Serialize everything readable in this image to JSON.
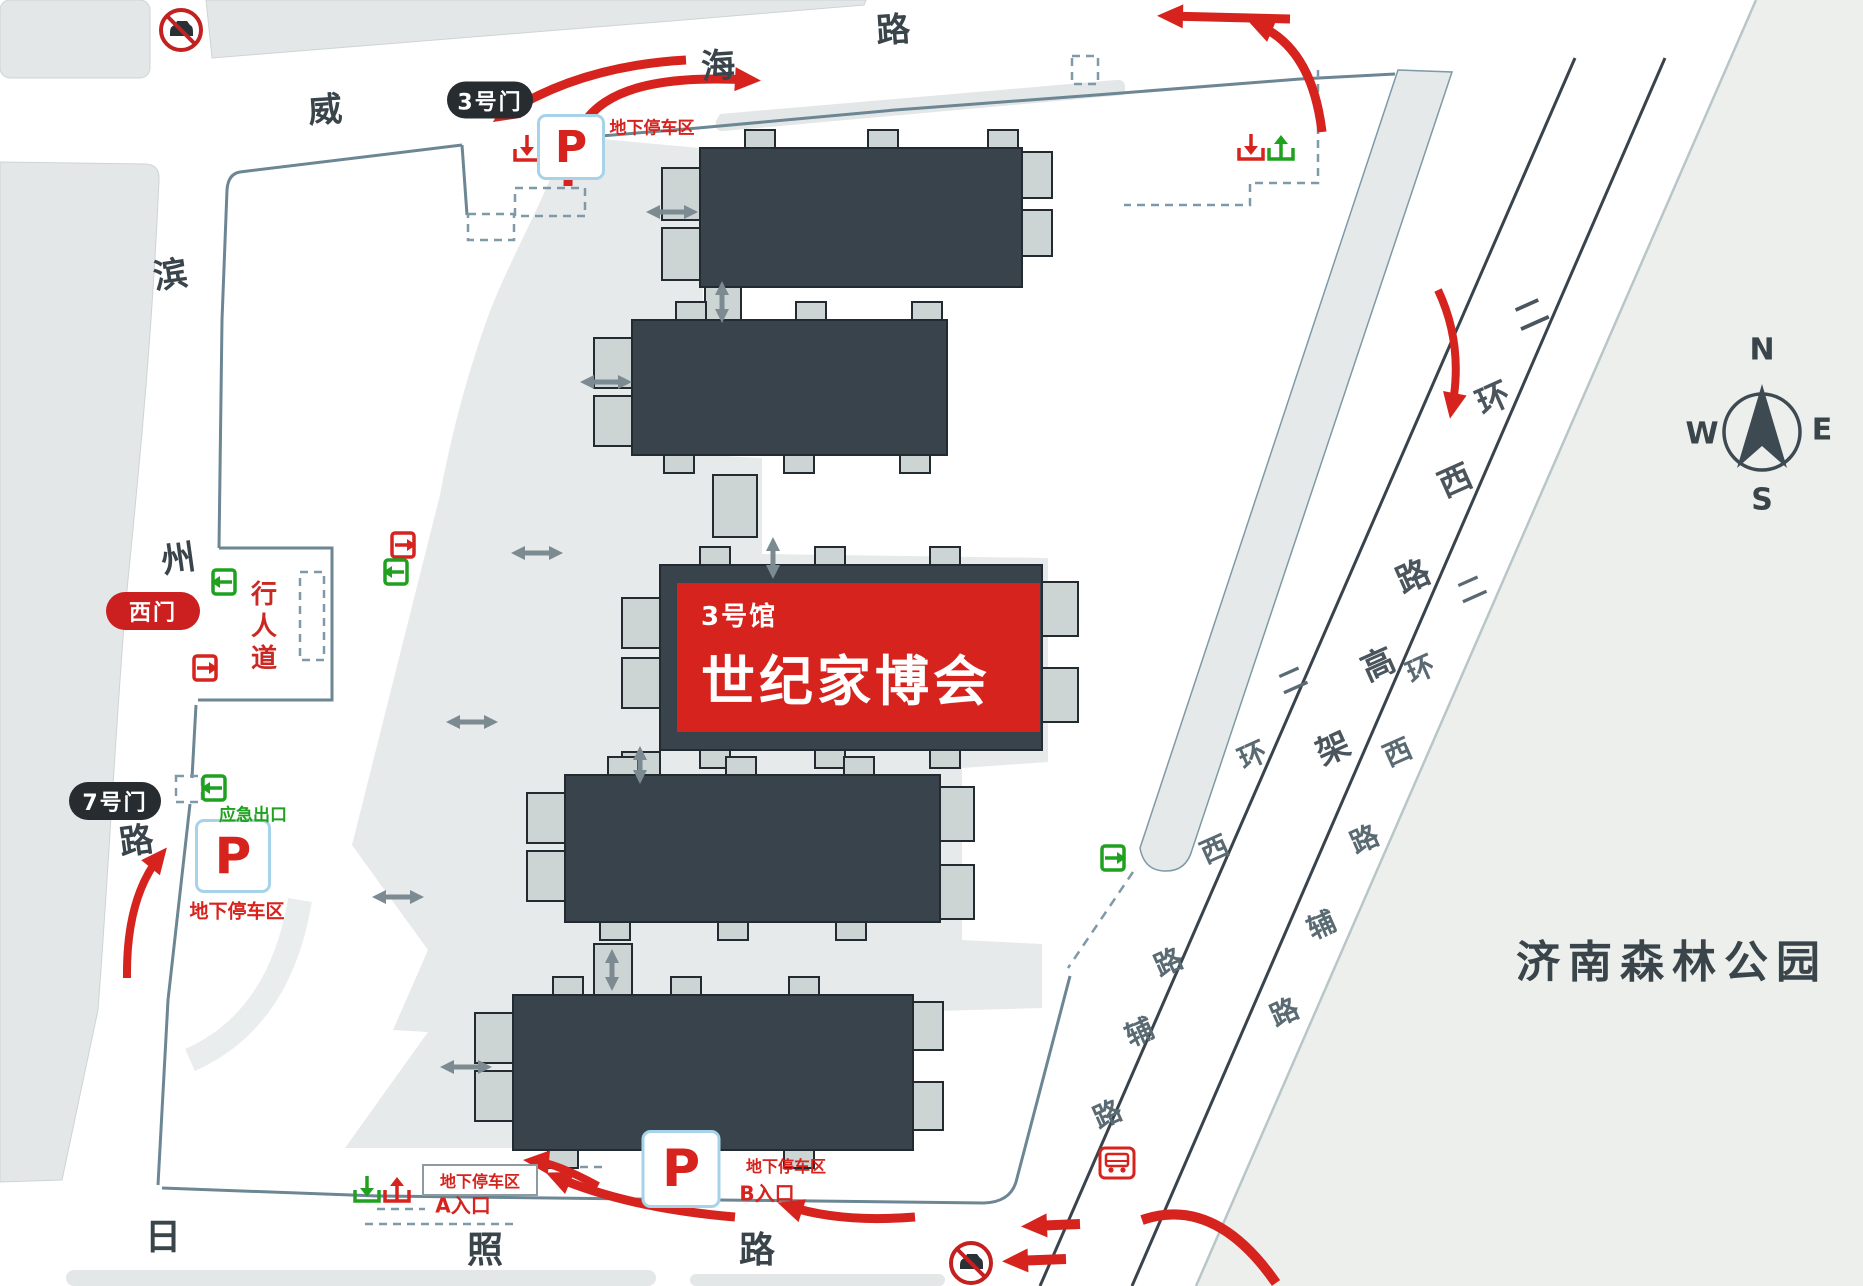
{
  "banner": {
    "hall_no": "3号馆",
    "title": "世纪家博会"
  },
  "park": {
    "name": "济南森林公园"
  },
  "compass": {
    "n": "N",
    "e": "E",
    "s": "S",
    "w": "W"
  },
  "gates": {
    "gate3": "3号门",
    "west_gate": "西门",
    "gate7": "7号门"
  },
  "parking": {
    "symbol": "P",
    "underground_label": "地下停车区",
    "entry_a": "A入口",
    "entry_b": "B入口",
    "emergency_exit": "应急出口",
    "walkway": "行人道"
  },
  "roads": {
    "weihai": "威海路",
    "binzhou": "滨州路",
    "rizhao": "日照路",
    "erhuan_elevated": "二环西路高架",
    "erhuan_service": "二环西路辅路"
  },
  "colors": {
    "accent_red": "#d7231e",
    "building_dark": "#39434c",
    "building_stub": "#ccd4d4",
    "green": "#1fa11f",
    "boundary_slate": "#6c8694",
    "p_border_blue": "#a6d3e8",
    "block_gray": "#e4e7e7",
    "park_gray": "#edefec"
  },
  "road_labels": [
    {
      "name": "road-weihai-char",
      "text": "威",
      "x": 325,
      "y": 107,
      "size": 34,
      "rot": -4,
      "color": "#39444b"
    },
    {
      "name": "road-weihai-char",
      "text": "海",
      "x": 718,
      "y": 63,
      "size": 34,
      "rot": -4,
      "color": "#39444b"
    },
    {
      "name": "road-weihai-char",
      "text": "路",
      "x": 893,
      "y": 27,
      "size": 34,
      "rot": -4,
      "color": "#39444b"
    },
    {
      "name": "road-binzhou-char",
      "text": "滨",
      "x": 170,
      "y": 272,
      "size": 34,
      "rot": -8,
      "color": "#39444b"
    },
    {
      "name": "road-binzhou-char",
      "text": "州",
      "x": 178,
      "y": 556,
      "size": 34,
      "rot": -8,
      "color": "#39444b"
    },
    {
      "name": "road-binzhou-char",
      "text": "路",
      "x": 136,
      "y": 838,
      "size": 34,
      "rot": -8,
      "color": "#39444b"
    },
    {
      "name": "road-rizhao-char",
      "text": "日",
      "x": 163,
      "y": 1234,
      "size": 36,
      "rot": 0,
      "color": "#39444b"
    },
    {
      "name": "road-rizhao-char",
      "text": "照",
      "x": 485,
      "y": 1247,
      "size": 36,
      "rot": 0,
      "color": "#39444b"
    },
    {
      "name": "road-rizhao-char",
      "text": "路",
      "x": 757,
      "y": 1247,
      "size": 36,
      "rot": 0,
      "color": "#39444b"
    },
    {
      "name": "road-elevated-char",
      "text": "二",
      "x": 1530,
      "y": 312,
      "size": 33,
      "rot": -24,
      "color": "#4a555d"
    },
    {
      "name": "road-elevated-char",
      "text": "环",
      "x": 1492,
      "y": 396,
      "size": 33,
      "rot": -24,
      "color": "#4a555d"
    },
    {
      "name": "road-elevated-char",
      "text": "西",
      "x": 1454,
      "y": 478,
      "size": 33,
      "rot": -24,
      "color": "#4a555d"
    },
    {
      "name": "road-elevated-char",
      "text": "路",
      "x": 1412,
      "y": 574,
      "size": 33,
      "rot": -24,
      "color": "#4a555d"
    },
    {
      "name": "road-elevated-char",
      "text": "高",
      "x": 1377,
      "y": 662,
      "size": 33,
      "rot": -24,
      "color": "#4a555d"
    },
    {
      "name": "road-elevated-char",
      "text": "架",
      "x": 1332,
      "y": 746,
      "size": 33,
      "rot": -24,
      "color": "#4a555d"
    },
    {
      "name": "road-service-right-char",
      "text": "二",
      "x": 1471,
      "y": 588,
      "size": 28,
      "rot": -24,
      "color": "#5a6a73"
    },
    {
      "name": "road-service-right-char",
      "text": "环",
      "x": 1420,
      "y": 668,
      "size": 28,
      "rot": -24,
      "color": "#5a6a73"
    },
    {
      "name": "road-service-right-char",
      "text": "西",
      "x": 1397,
      "y": 751,
      "size": 28,
      "rot": -24,
      "color": "#5a6a73"
    },
    {
      "name": "road-service-right-char",
      "text": "路",
      "x": 1364,
      "y": 838,
      "size": 28,
      "rot": -24,
      "color": "#5a6a73"
    },
    {
      "name": "road-service-right-char",
      "text": "辅",
      "x": 1321,
      "y": 924,
      "size": 28,
      "rot": -24,
      "color": "#5a6a73"
    },
    {
      "name": "road-service-right-char",
      "text": "路",
      "x": 1284,
      "y": 1011,
      "size": 28,
      "rot": -24,
      "color": "#5a6a73"
    },
    {
      "name": "road-service-left-char",
      "text": "二",
      "x": 1292,
      "y": 679,
      "size": 28,
      "rot": -24,
      "color": "#5a6a73"
    },
    {
      "name": "road-service-left-char",
      "text": "环",
      "x": 1252,
      "y": 754,
      "size": 28,
      "rot": -24,
      "color": "#5a6a73"
    },
    {
      "name": "road-service-left-char",
      "text": "西",
      "x": 1214,
      "y": 848,
      "size": 28,
      "rot": -24,
      "color": "#5a6a73"
    },
    {
      "name": "road-service-left-char",
      "text": "路",
      "x": 1168,
      "y": 961,
      "size": 28,
      "rot": -24,
      "color": "#5a6a73"
    },
    {
      "name": "road-service-left-char",
      "text": "辅",
      "x": 1139,
      "y": 1031,
      "size": 28,
      "rot": -24,
      "color": "#5a6a73"
    },
    {
      "name": "road-service-left-char",
      "text": "路",
      "x": 1107,
      "y": 1113,
      "size": 28,
      "rot": -24,
      "color": "#5a6a73"
    }
  ]
}
